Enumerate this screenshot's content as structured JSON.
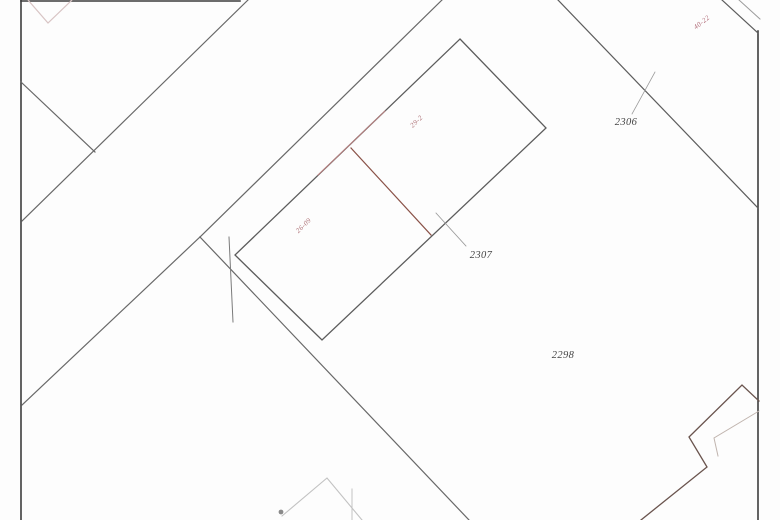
{
  "map": {
    "title": "cadastral-parcel-sketch",
    "background": "#fdfdfd",
    "accent_red": "#ac6f74",
    "border_color": "#3d3d3d",
    "boundary_color": "#686868",
    "lines": [
      {
        "name": "left-border-line",
        "points": [
          [
            21,
            0
          ],
          [
            21,
            520
          ]
        ],
        "color": "#3d3d3d",
        "width": 1.6
      },
      {
        "name": "top-border-line",
        "points": [
          [
            21,
            1
          ],
          [
            240,
            1
          ]
        ],
        "color": "#3d3d3d",
        "width": 1.6
      },
      {
        "name": "right-border-line",
        "points": [
          [
            758,
            31
          ],
          [
            758,
            520
          ]
        ],
        "color": "#3d3d3d",
        "width": 1.6
      },
      {
        "name": "topright-strip-outer-line",
        "points": [
          [
            722,
            0
          ],
          [
            758,
            33
          ]
        ],
        "color": "#5c5c5c",
        "width": 1.2
      },
      {
        "name": "topright-strip-inner-line",
        "points": [
          [
            739,
            0
          ],
          [
            760,
            19
          ]
        ],
        "color": "#9a9a9a",
        "width": 1.0
      },
      {
        "name": "faint-v-line",
        "points": [
          [
            28,
            0
          ],
          [
            48,
            23
          ],
          [
            72,
            0
          ]
        ],
        "color": "#d8c4c4",
        "width": 1.2
      },
      {
        "name": "west-spur-boundary-line",
        "points": [
          [
            21,
            82
          ],
          [
            95,
            152
          ]
        ],
        "color": "#686868",
        "width": 1.2
      },
      {
        "name": "northwest-diagonal-boundary",
        "points": [
          [
            248,
            0
          ],
          [
            22,
            221
          ]
        ],
        "color": "#686868",
        "width": 1.2
      },
      {
        "name": "parcel-west-boundary-line",
        "points": [
          [
            442,
            0
          ],
          [
            200,
            237
          ]
        ],
        "color": "#686868",
        "width": 1.2
      },
      {
        "name": "boundary-to-left-border",
        "points": [
          [
            200,
            237
          ],
          [
            22,
            405
          ]
        ],
        "color": "#686868",
        "width": 1.2
      },
      {
        "name": "boundary-southeast-line",
        "points": [
          [
            200,
            237
          ],
          [
            469,
            520
          ]
        ],
        "color": "#686868",
        "width": 1.2
      },
      {
        "name": "boundary-stub-line",
        "points": [
          [
            229,
            237
          ],
          [
            233,
            322
          ]
        ],
        "color": "#7a7a7a",
        "width": 1.0
      },
      {
        "name": "building-outline",
        "points": [
          [
            460,
            39
          ],
          [
            546,
            128
          ],
          [
            322,
            340
          ],
          [
            235,
            255
          ],
          [
            460,
            39
          ]
        ],
        "color": "#5c5c5c",
        "width": 1.3
      },
      {
        "name": "building-divider-line",
        "points": [
          [
            351,
            148
          ],
          [
            431,
            235
          ]
        ],
        "color": "#8a5248",
        "width": 1.2
      },
      {
        "name": "red-edge-segment",
        "points": [
          [
            318,
            175
          ],
          [
            385,
            111
          ]
        ],
        "color": "#b87e7e",
        "width": 1.0
      },
      {
        "name": "northeast-diagonal-boundary",
        "points": [
          [
            558,
            0
          ],
          [
            758,
            208
          ]
        ],
        "color": "#5c5c5c",
        "width": 1.2
      },
      {
        "name": "leader-line-2306",
        "points": [
          [
            632,
            114
          ],
          [
            655,
            72
          ]
        ],
        "color": "#9a9a9a",
        "width": 0.8
      },
      {
        "name": "leader-line-2307",
        "points": [
          [
            436,
            213
          ],
          [
            466,
            246
          ]
        ],
        "color": "#9a9a9a",
        "width": 0.8
      },
      {
        "name": "southeast-zigzag-boundary",
        "points": [
          [
            759,
            401
          ],
          [
            742,
            385
          ],
          [
            689,
            437
          ],
          [
            707,
            467
          ],
          [
            641,
            520
          ]
        ],
        "color": "#6a544e",
        "width": 1.3
      },
      {
        "name": "southeast-zigzag-inner-line",
        "points": [
          [
            759,
            411
          ],
          [
            714,
            438
          ],
          [
            718,
            456
          ]
        ],
        "color": "#c0b4ae",
        "width": 1.0
      },
      {
        "name": "bottom-building-outline",
        "points": [
          [
            282,
            516
          ],
          [
            327,
            478
          ],
          [
            362,
            520
          ]
        ],
        "color": "#c2c2c2",
        "width": 1.1
      },
      {
        "name": "bottom-building-inner-line",
        "points": [
          [
            352,
            489
          ],
          [
            352,
            520
          ]
        ],
        "color": "#c2c2c2",
        "width": 1.0
      }
    ],
    "labels": [
      {
        "name": "parcel-label-2306",
        "text": "2306",
        "x": 626,
        "y": 125,
        "rotate": 0,
        "color": "#454545",
        "size": 10.5,
        "italic": true
      },
      {
        "name": "parcel-label-2307",
        "text": "2307",
        "x": 481,
        "y": 258,
        "rotate": 0,
        "color": "#454545",
        "size": 10.5,
        "italic": true
      },
      {
        "name": "parcel-label-2298",
        "text": "2298",
        "x": 563,
        "y": 358,
        "rotate": 0,
        "color": "#454545",
        "size": 10.5,
        "italic": true
      },
      {
        "name": "dimension-label-29-2",
        "text": "29-2",
        "x": 418,
        "y": 123,
        "rotate": -44,
        "color": "#ac6f74",
        "size": 7,
        "italic": true
      },
      {
        "name": "dimension-label-26-09",
        "text": "26-09",
        "x": 305,
        "y": 227,
        "rotate": -44,
        "color": "#ac6f74",
        "size": 7,
        "italic": true
      },
      {
        "name": "dimension-label-40-22",
        "text": "40-22",
        "x": 703,
        "y": 24,
        "rotate": -38,
        "color": "#b06c78",
        "size": 7,
        "italic": true
      }
    ],
    "dots": [
      {
        "name": "survey-mark-dot",
        "x": 281,
        "y": 512,
        "r": 2.4,
        "color": "#8a8a8a"
      }
    ]
  }
}
